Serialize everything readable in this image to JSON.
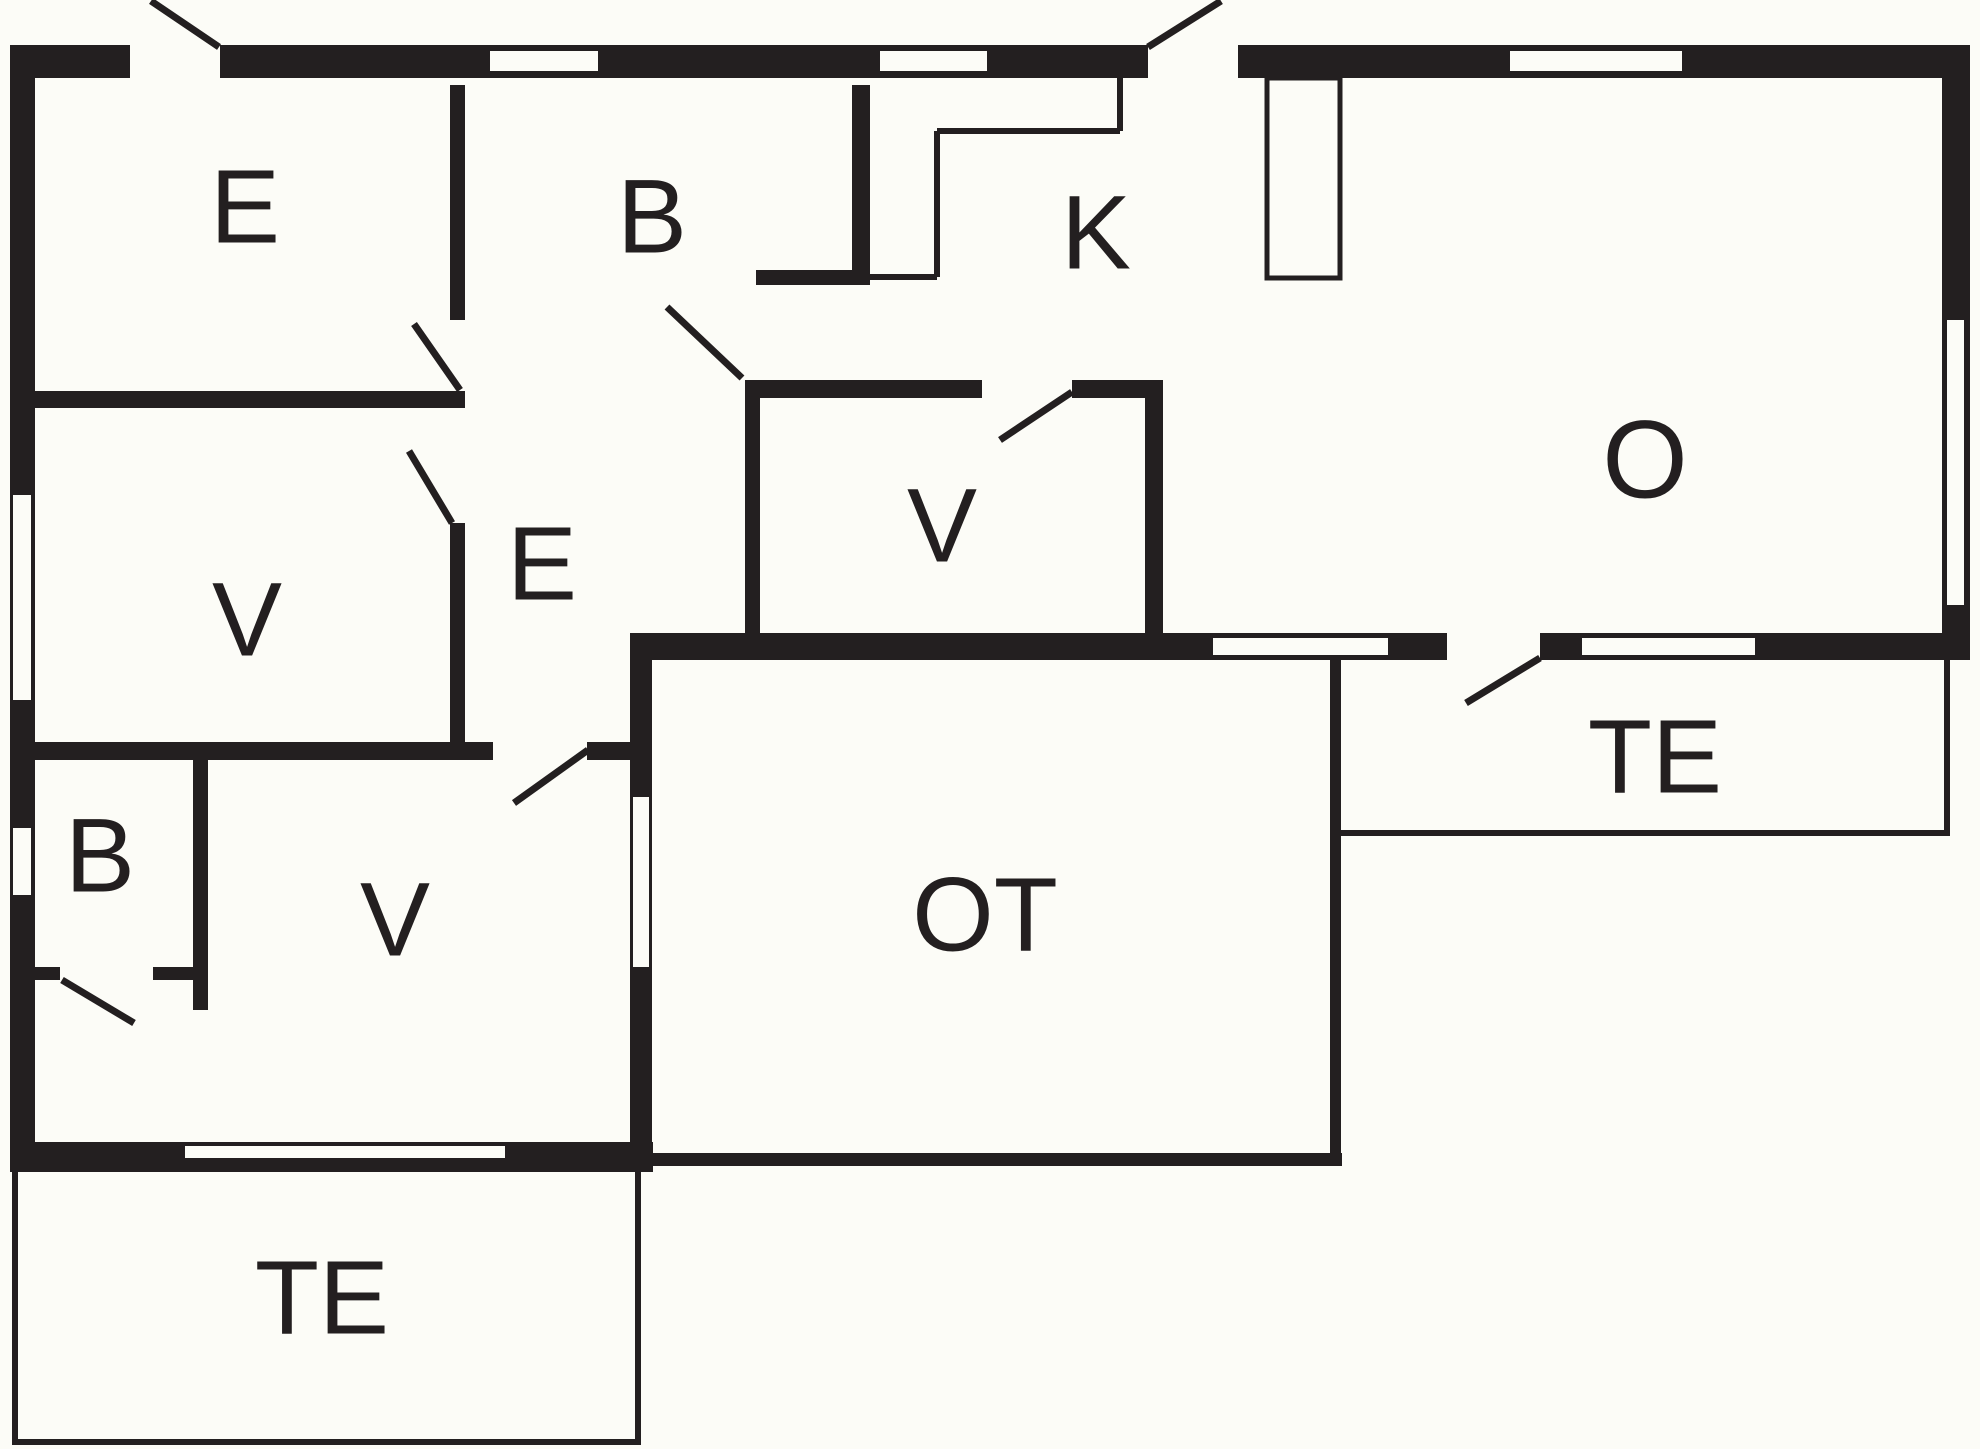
{
  "page_title": "Floor plan",
  "canvas": {
    "width": 1980,
    "height": 1449,
    "background": "#FCFCF7",
    "ink": "#231F20"
  },
  "room_labels": [
    {
      "id": "entrance-top",
      "text": "E",
      "x": 245,
      "y": 207,
      "size": 105
    },
    {
      "id": "bath-top",
      "text": "B",
      "x": 652,
      "y": 217,
      "size": 105
    },
    {
      "id": "kitchen",
      "text": "K",
      "x": 1096,
      "y": 233,
      "size": 105
    },
    {
      "id": "living-room",
      "text": "O",
      "x": 1645,
      "y": 460,
      "size": 110
    },
    {
      "id": "bedroom-left",
      "text": "V",
      "x": 247,
      "y": 620,
      "size": 105
    },
    {
      "id": "hallway",
      "text": "E",
      "x": 542,
      "y": 564,
      "size": 105
    },
    {
      "id": "bedroom-mid",
      "text": "V",
      "x": 942,
      "y": 526,
      "size": 105
    },
    {
      "id": "terrace-right",
      "text": "TE",
      "x": 1655,
      "y": 757,
      "size": 105
    },
    {
      "id": "bath-bottom",
      "text": "B",
      "x": 100,
      "y": 856,
      "size": 105
    },
    {
      "id": "bedroom-bottom",
      "text": "V",
      "x": 395,
      "y": 920,
      "size": 105
    },
    {
      "id": "outbuilding",
      "text": "OT",
      "x": 985,
      "y": 915,
      "size": 105
    },
    {
      "id": "terrace-bottom",
      "text": "TE",
      "x": 322,
      "y": 1298,
      "size": 105
    }
  ],
  "walls": [
    [
      10,
      45,
      120,
      33
    ],
    [
      220,
      45,
      928,
      33
    ],
    [
      1238,
      45,
      730,
      33
    ],
    [
      10,
      45,
      25,
      1127
    ],
    [
      1942,
      45,
      28,
      615
    ],
    [
      10,
      1142,
      643,
      30
    ],
    [
      630,
      633,
      817,
      27
    ],
    [
      1540,
      633,
      420,
      27
    ],
    [
      630,
      633,
      22,
      539
    ],
    [
      652,
      1153,
      690,
      13
    ],
    [
      1330,
      660,
      11,
      506
    ],
    [
      450,
      85,
      15,
      235
    ],
    [
      450,
      523,
      15,
      219
    ],
    [
      25,
      391,
      440,
      17
    ],
    [
      852,
      85,
      18,
      200
    ],
    [
      756,
      270,
      114,
      15
    ],
    [
      745,
      380,
      237,
      18
    ],
    [
      1072,
      380,
      91,
      18
    ],
    [
      745,
      380,
      15,
      253
    ],
    [
      1145,
      380,
      18,
      253
    ],
    [
      25,
      742,
      468,
      18
    ],
    [
      587,
      742,
      58,
      18
    ],
    [
      193,
      757,
      15,
      253
    ],
    [
      28,
      967,
      32,
      13
    ],
    [
      153,
      967,
      55,
      13
    ]
  ],
  "windows": [
    [
      490,
      51,
      108,
      20
    ],
    [
      880,
      51,
      107,
      20
    ],
    [
      1510,
      51,
      172,
      20
    ],
    [
      13,
      495,
      18,
      205
    ],
    [
      13,
      828,
      18,
      67
    ],
    [
      1947,
      320,
      17,
      285
    ],
    [
      185,
      1146,
      320,
      12
    ],
    [
      1213,
      638,
      175,
      17
    ],
    [
      1582,
      638,
      173,
      17
    ],
    [
      633,
      797,
      16,
      170
    ]
  ],
  "island_counter": {
    "x": 1267,
    "y": 78,
    "w": 73,
    "h": 200
  },
  "counter_lines": [
    [
      1120,
      78,
      1120,
      131
    ],
    [
      937,
      131,
      1120,
      131
    ],
    [
      937,
      131,
      937,
      277
    ],
    [
      870,
      277,
      937,
      277
    ]
  ],
  "terrace_lines": [
    [
      15,
      1172,
      15,
      1445
    ],
    [
      12,
      1442,
      641,
      1442
    ],
    [
      638,
      1172,
      638,
      1445
    ],
    [
      1337,
      833,
      1950,
      833
    ],
    [
      1947,
      660,
      1947,
      833
    ]
  ],
  "door_leaves": [
    [
      219,
      47,
      151,
      1
    ],
    [
      1148,
      47,
      1221,
      1
    ],
    [
      460,
      390,
      414,
      324
    ],
    [
      452,
      523,
      409,
      451
    ],
    [
      742,
      378,
      667,
      307
    ],
    [
      1072,
      392,
      1000,
      440
    ],
    [
      588,
      750,
      514,
      803
    ],
    [
      62,
      980,
      134,
      1023
    ],
    [
      1540,
      658,
      1466,
      703
    ]
  ]
}
